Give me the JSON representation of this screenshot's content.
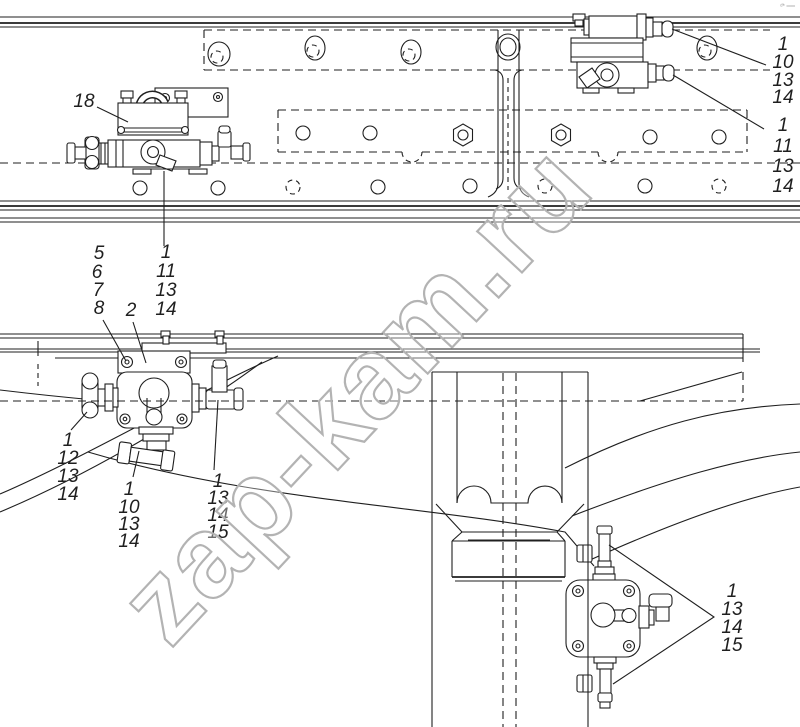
{
  "diagram": {
    "watermark": "zap-kam.ru",
    "corner_mark": "ᵈ* ══",
    "colors": {
      "ink": "#1f1f1f",
      "watermark": "#b3b3b3",
      "background": "#ffffff"
    },
    "callouts": {
      "part18": "18",
      "part2": "2",
      "stack_mount": [
        "5",
        "6",
        "7",
        "8"
      ],
      "stack_top_a": [
        "1",
        "10",
        "13",
        "14"
      ],
      "stack_top_b": [
        "1",
        "11",
        "13",
        "14"
      ],
      "stack_left_valve": [
        "1",
        "11",
        "13",
        "14"
      ],
      "stack_mid_left": [
        "1",
        "12",
        "13",
        "14"
      ],
      "stack_mid_bottom": [
        "1",
        "10",
        "13",
        "14"
      ],
      "stack_mid_right": [
        "1",
        "13",
        "14",
        "15"
      ],
      "stack_bottom_right": [
        "1",
        "13",
        "14",
        "15"
      ]
    }
  }
}
